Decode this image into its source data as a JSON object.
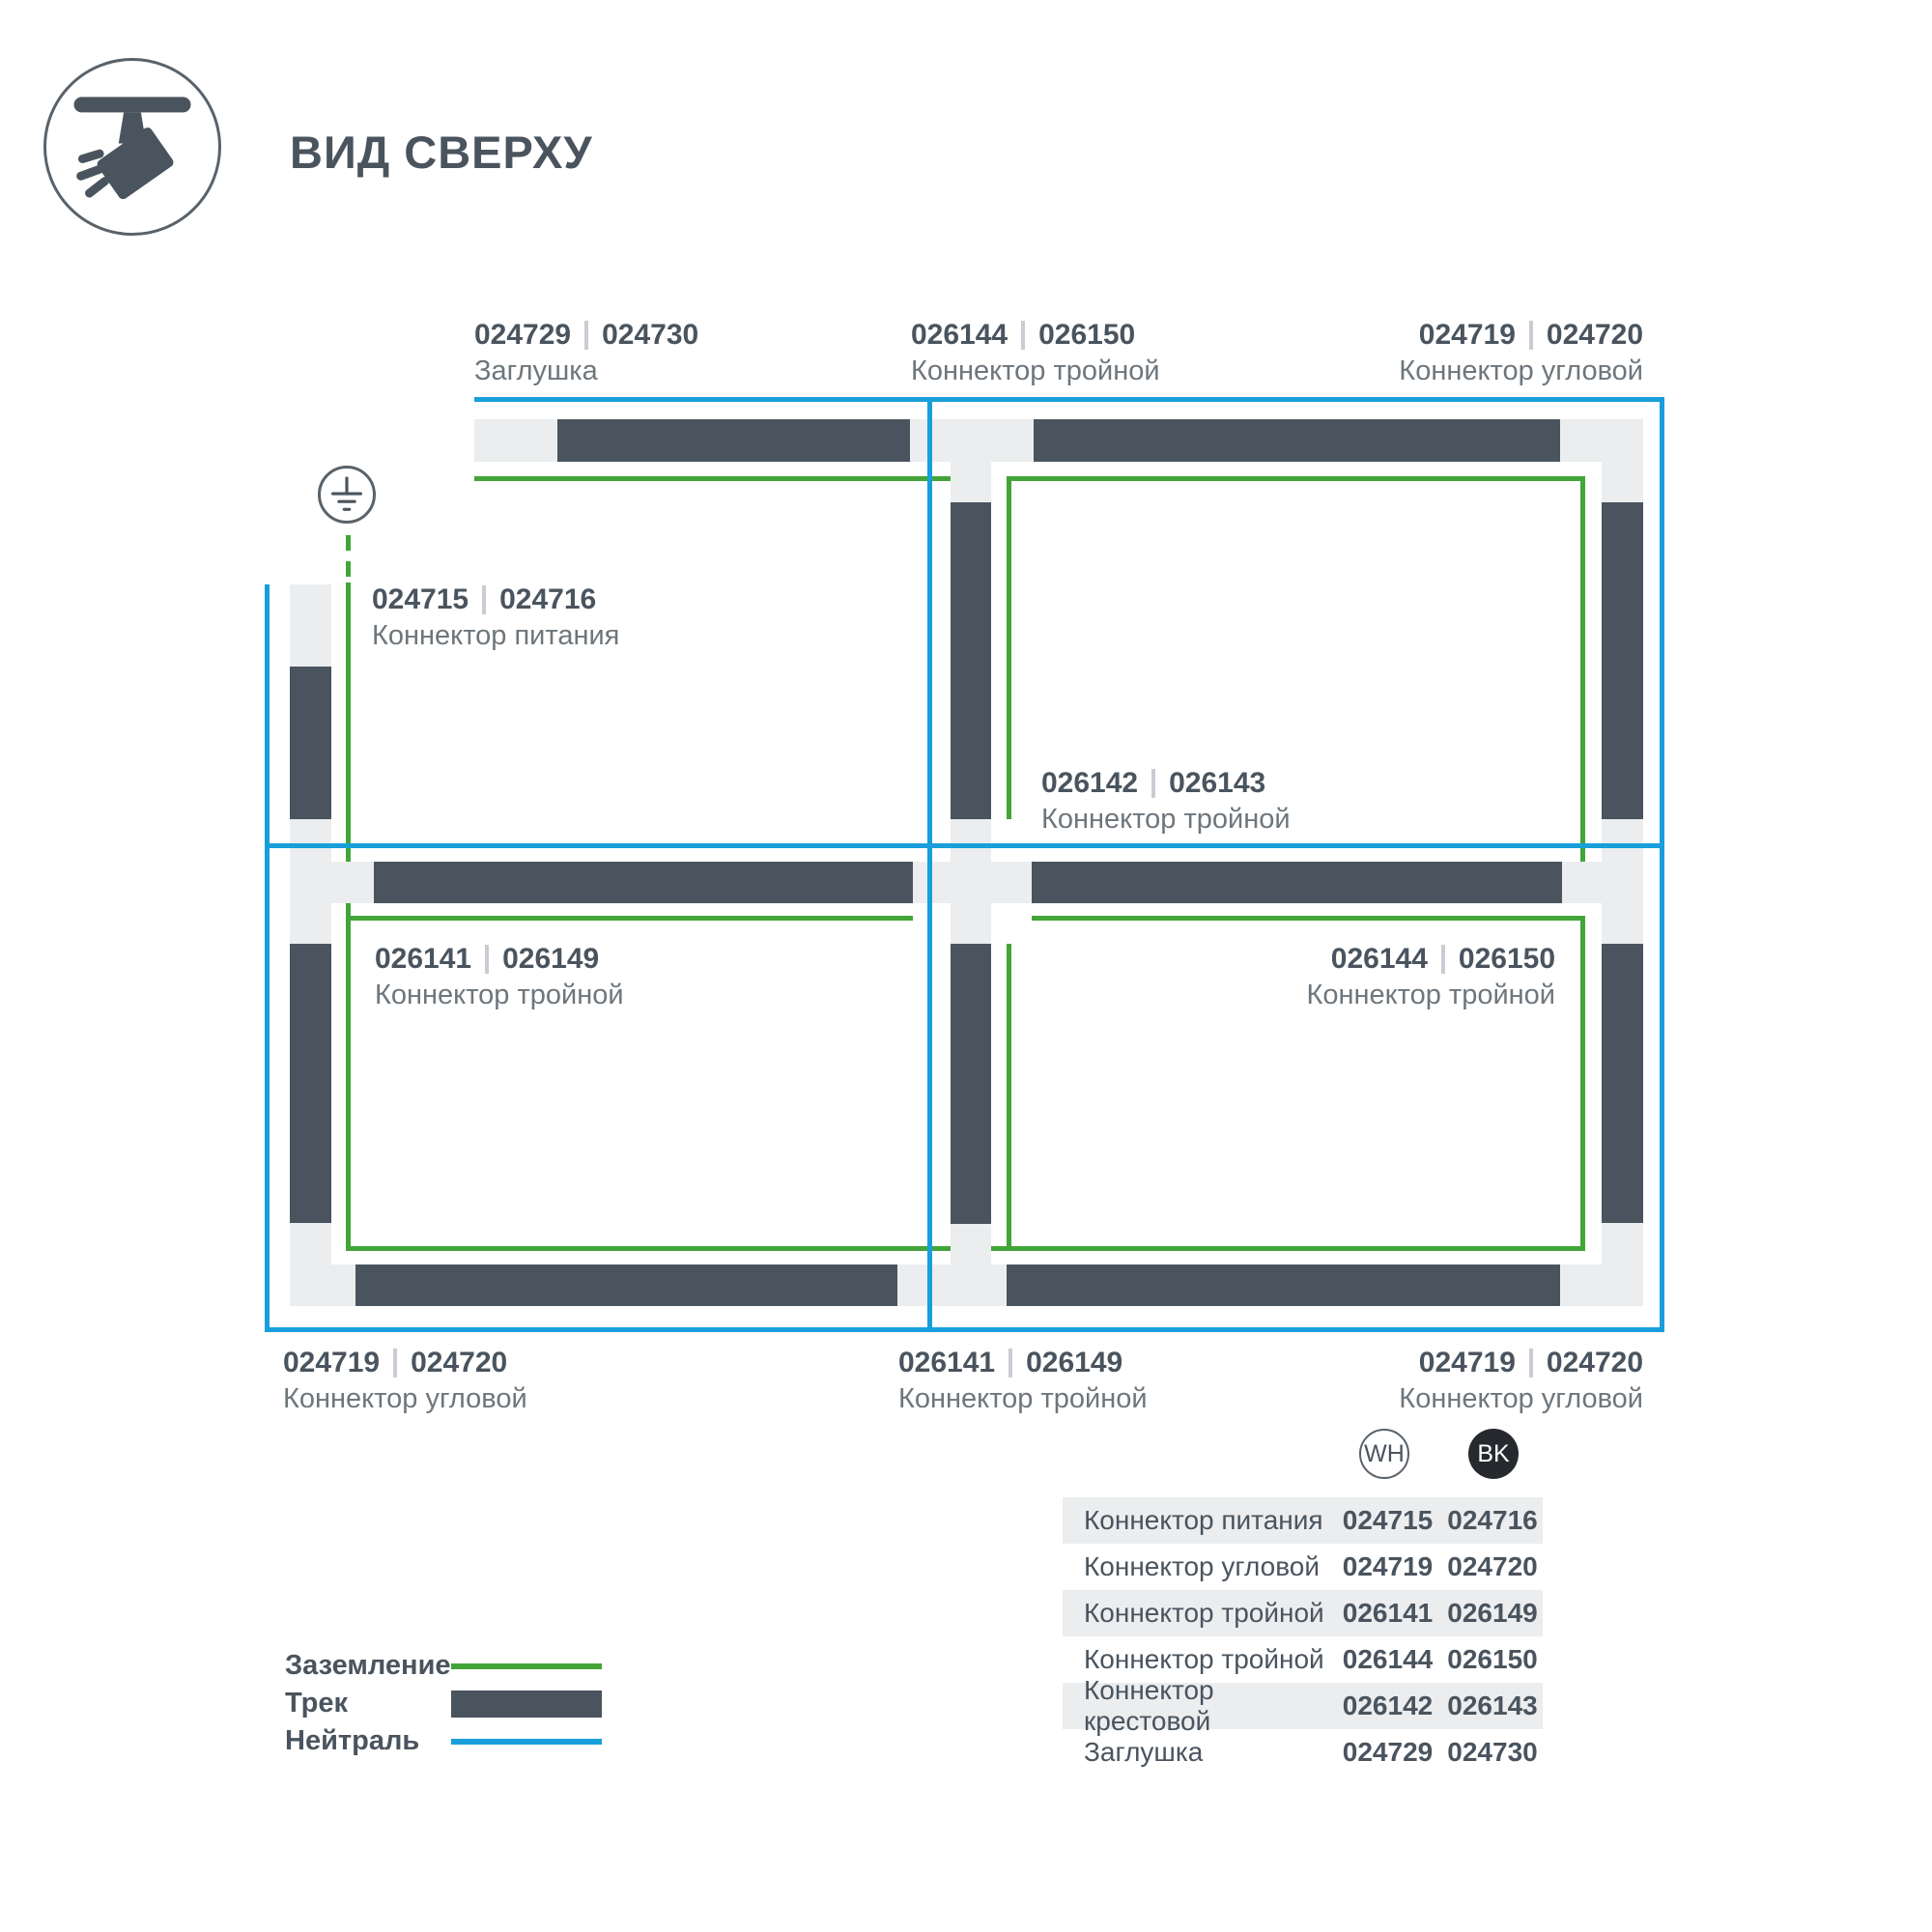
{
  "header": {
    "title": "ВИД СВЕРХУ"
  },
  "colors": {
    "track": "#4a545e",
    "ground": "#43a539",
    "neutral": "#189fdb",
    "connector_light": "#ebedee",
    "text_primary": "#4a545e",
    "text_secondary": "#6e767c",
    "bk_badge": "#26292e"
  },
  "diagram": {
    "labels": [
      {
        "wh": "024729",
        "bk": "024730",
        "name": "Заглушка"
      },
      {
        "wh": "026144",
        "bk": "026150",
        "name": "Коннектор тройной"
      },
      {
        "wh": "024719",
        "bk": "024720",
        "name": "Коннектор угловой"
      },
      {
        "wh": "024715",
        "bk": "024716",
        "name": "Коннектор питания"
      },
      {
        "wh": "026142",
        "bk": "026143",
        "name": "Коннектор тройной"
      },
      {
        "wh": "026141",
        "bk": "026149",
        "name": "Коннектор тройной"
      },
      {
        "wh": "026144",
        "bk": "026150",
        "name": "Коннектор тройной"
      },
      {
        "wh": "024719",
        "bk": "024720",
        "name": "Коннектор угловой"
      },
      {
        "wh": "026141",
        "bk": "026149",
        "name": "Коннектор тройной"
      },
      {
        "wh": "024719",
        "bk": "024720",
        "name": "Коннектор угловой"
      }
    ]
  },
  "legend": {
    "items": [
      {
        "label": "Заземление",
        "type": "ground"
      },
      {
        "label": "Трек",
        "type": "track"
      },
      {
        "label": "Нейтраль",
        "type": "neutral"
      }
    ]
  },
  "table": {
    "header": {
      "wh": "WH",
      "bk": "BK"
    },
    "rows": [
      {
        "name": "Коннектор питания",
        "wh": "024715",
        "bk": "024716"
      },
      {
        "name": "Коннектор угловой",
        "wh": "024719",
        "bk": "024720"
      },
      {
        "name": "Коннектор тройной",
        "wh": "026141",
        "bk": "026149"
      },
      {
        "name": "Коннектор тройной",
        "wh": "026144",
        "bk": "026150"
      },
      {
        "name": "Коннектор крестовой",
        "wh": "026142",
        "bk": "026143"
      },
      {
        "name": "Заглушка",
        "wh": "024729",
        "bk": "024730"
      }
    ]
  }
}
